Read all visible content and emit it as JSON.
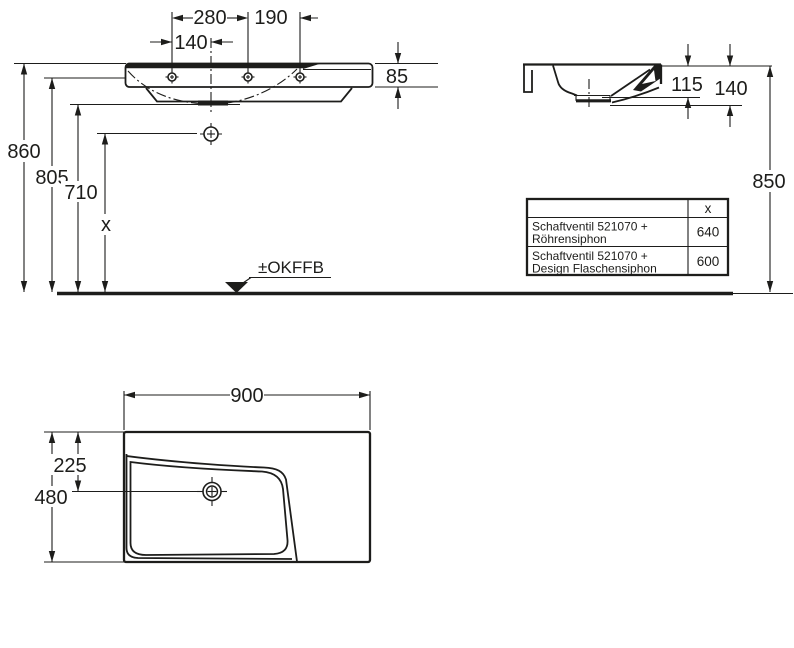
{
  "drawing_type": "washbasin technical dimension drawing",
  "dims": {
    "d280": "280",
    "d190": "190",
    "d140_front": "140",
    "d85": "85",
    "d860": "860",
    "d805": "805",
    "d710": "710",
    "dx": "x",
    "d115": "115",
    "d140_side": "140",
    "d850": "850",
    "d900": "900",
    "d480": "480",
    "d225": "225"
  },
  "floor_marker_label": "±OKFFB",
  "table": {
    "header_x": "x",
    "rows": [
      {
        "line1": "Schaftventil 521070 +",
        "line2": "Röhrensiphon",
        "value": "640"
      },
      {
        "line1": "Schaftventil 521070 +",
        "line2": "Design Flaschensiphon",
        "value": "600"
      }
    ]
  },
  "colors": {
    "line": "#1d1d1b",
    "background": "#ffffff"
  }
}
